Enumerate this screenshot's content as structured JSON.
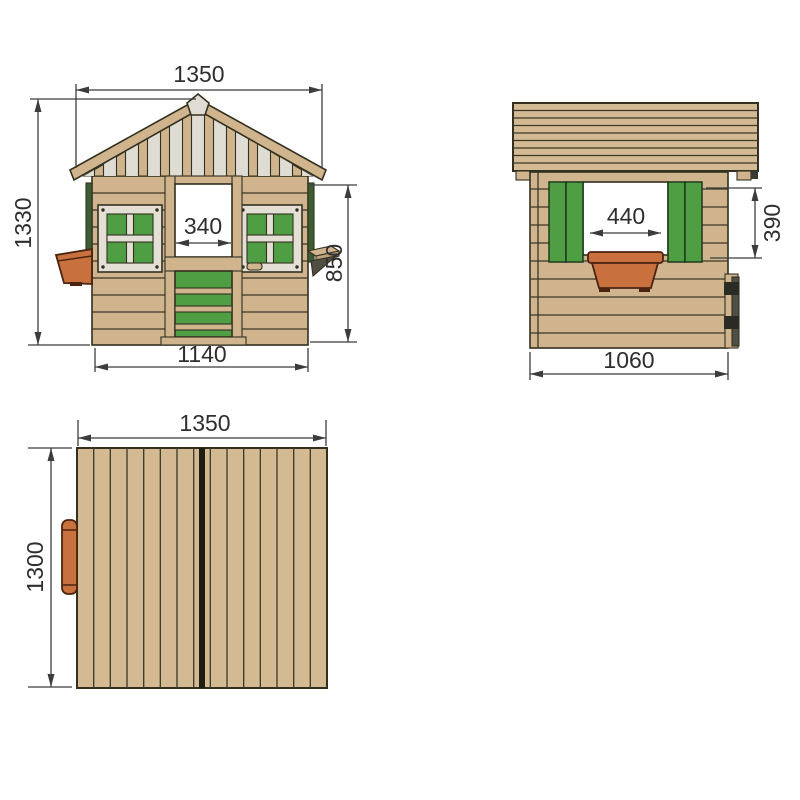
{
  "drawing": {
    "views": {
      "front": {
        "dims": {
          "roof_width": "1350",
          "overall_height": "1330",
          "door_opening_width": "340",
          "wall_height": "850",
          "base_width": "1140"
        }
      },
      "side": {
        "dims": {
          "window_opening_width": "440",
          "window_opening_height": "390",
          "base_depth": "1060"
        }
      },
      "top": {
        "dims": {
          "roof_width": "1350",
          "roof_depth": "1300"
        }
      }
    },
    "colors": {
      "wood": "#cfb48e",
      "wood_roof": "#d4ba92",
      "gable_slat": "#dfdcd3",
      "frame_cream": "#e3dfd5",
      "green": "#4f9e44",
      "dark_green_trim": "#3c5c34",
      "terracotta": "#c8703e",
      "outline": "#33301f",
      "dimension_line": "#3c3c3c",
      "background": "#ffffff"
    }
  }
}
